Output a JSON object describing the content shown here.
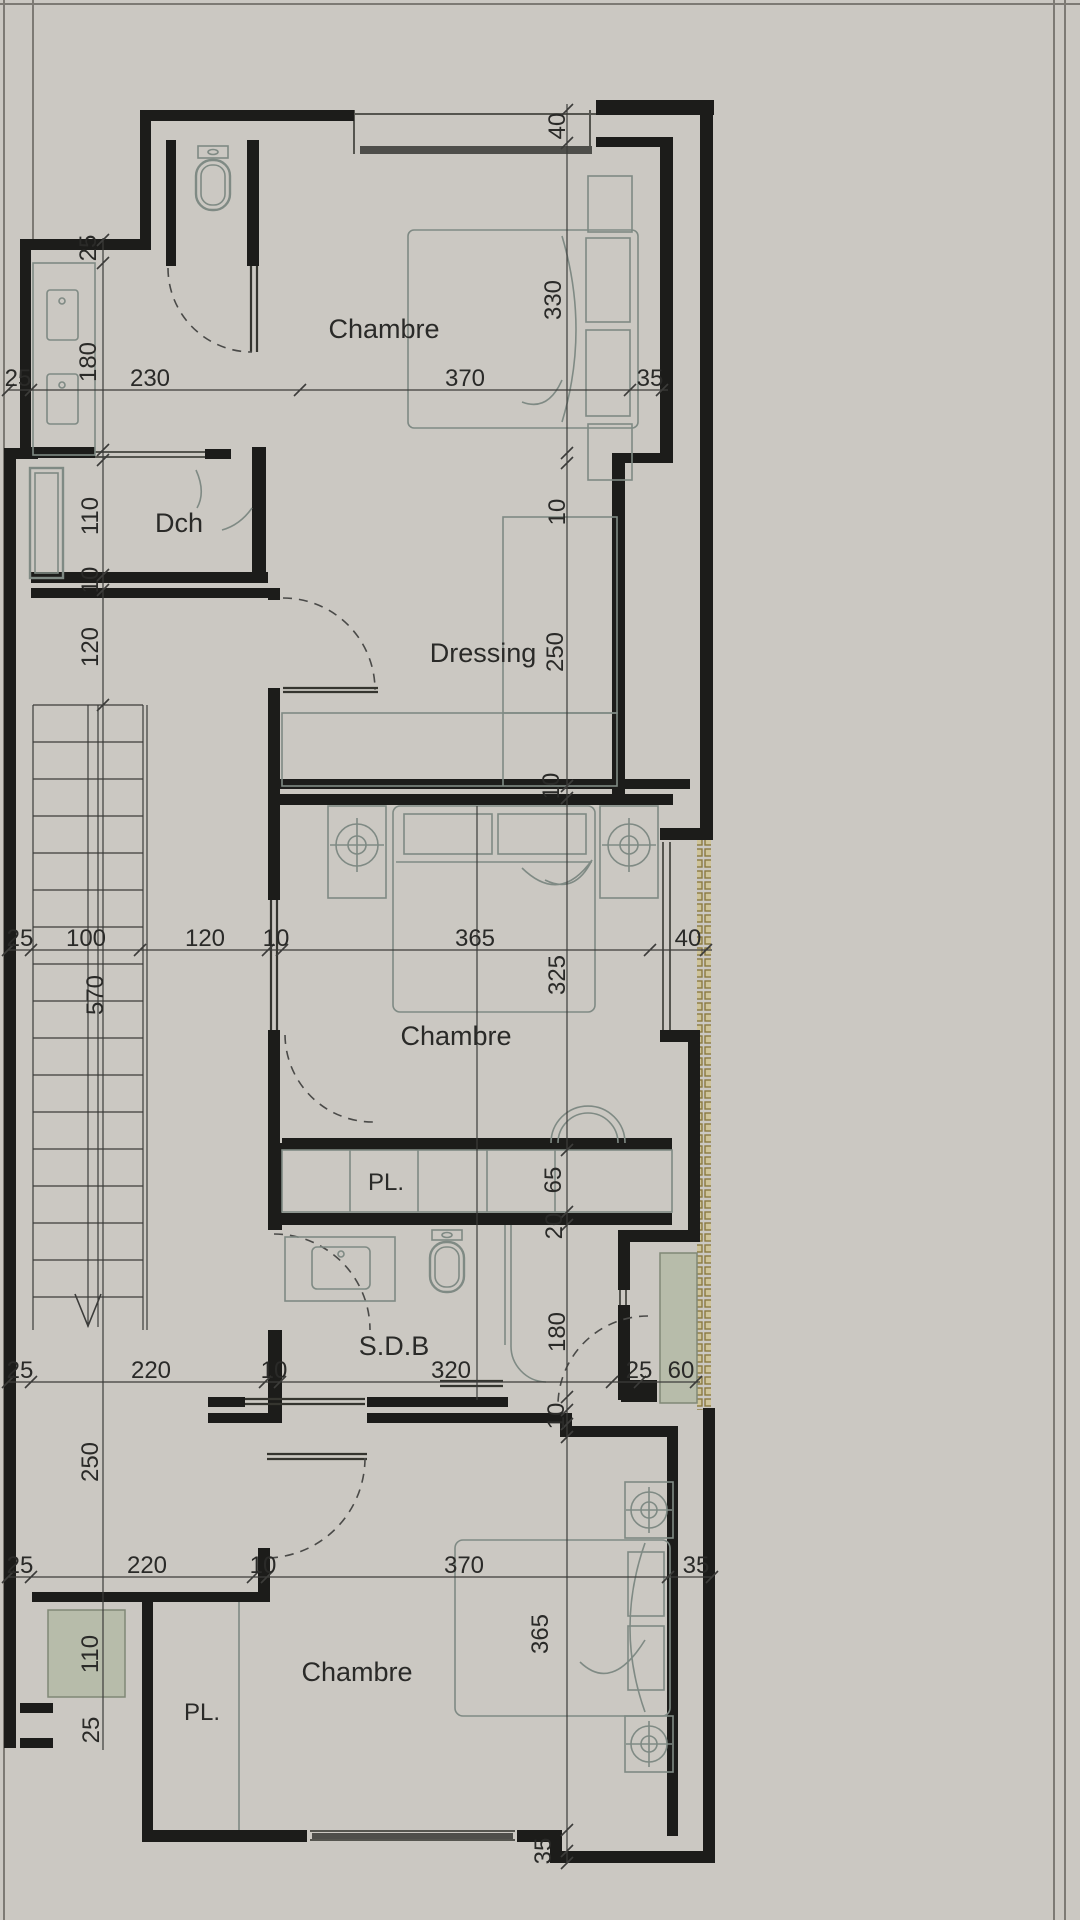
{
  "drawing": {
    "type": "architectural floor plan",
    "background": "#cbc8c2",
    "wall_color": "#1c1c1a",
    "furniture_color": "#7f8a84",
    "dimension_color": "#3c3c3a",
    "window_color": "#55554f",
    "boundary_color": "#7d7a74",
    "hatch_stroke": "#8a7940",
    "hatch_fill": "#cfc49a",
    "planter_fill": "#b7bcaa"
  },
  "rooms": {
    "chambre_top": "Chambre",
    "dch": "Dch",
    "dressing": "Dressing",
    "chambre_mid": "Chambre",
    "pl_mid": "PL.",
    "sdb": "S.D.B",
    "chambre_bottom": "Chambre",
    "pl_bottom": "PL."
  },
  "dims": {
    "v40_top": "40",
    "v330_chambre_top": "330",
    "v25_left_top": "25",
    "v180_vanity": "180",
    "v110_dch": "110",
    "v10_dch_wall": "10",
    "v120_hall": "120",
    "v10_dressing_wall": "10",
    "v250_dressing": "250",
    "v10_mid_wall": "10",
    "v325_chambre_mid": "325",
    "v570_stairs": "570",
    "v65_closet": "65",
    "v20_wall": "20",
    "v180_sdb": "180",
    "v10_sdb_wall": "10",
    "v250_hall_bottom": "250",
    "v110_planter": "110",
    "v25_niche": "25",
    "v365_chambre_bottom": "365",
    "v35_bottom_wall": "35",
    "rowA": {
      "d25": "25",
      "d230": "230",
      "d370": "370",
      "d35": "35"
    },
    "rowB": {
      "d25": "25",
      "d100": "100",
      "d120": "120",
      "d10": "10",
      "d365": "365",
      "d40": "40"
    },
    "rowC": {
      "d25": "25",
      "d220": "220",
      "d10": "10",
      "d320": "320",
      "d25b": "25",
      "d60": "60"
    },
    "rowD": {
      "d25": "25",
      "d220": "220",
      "d10": "10",
      "d370": "370",
      "d35": "35"
    }
  }
}
